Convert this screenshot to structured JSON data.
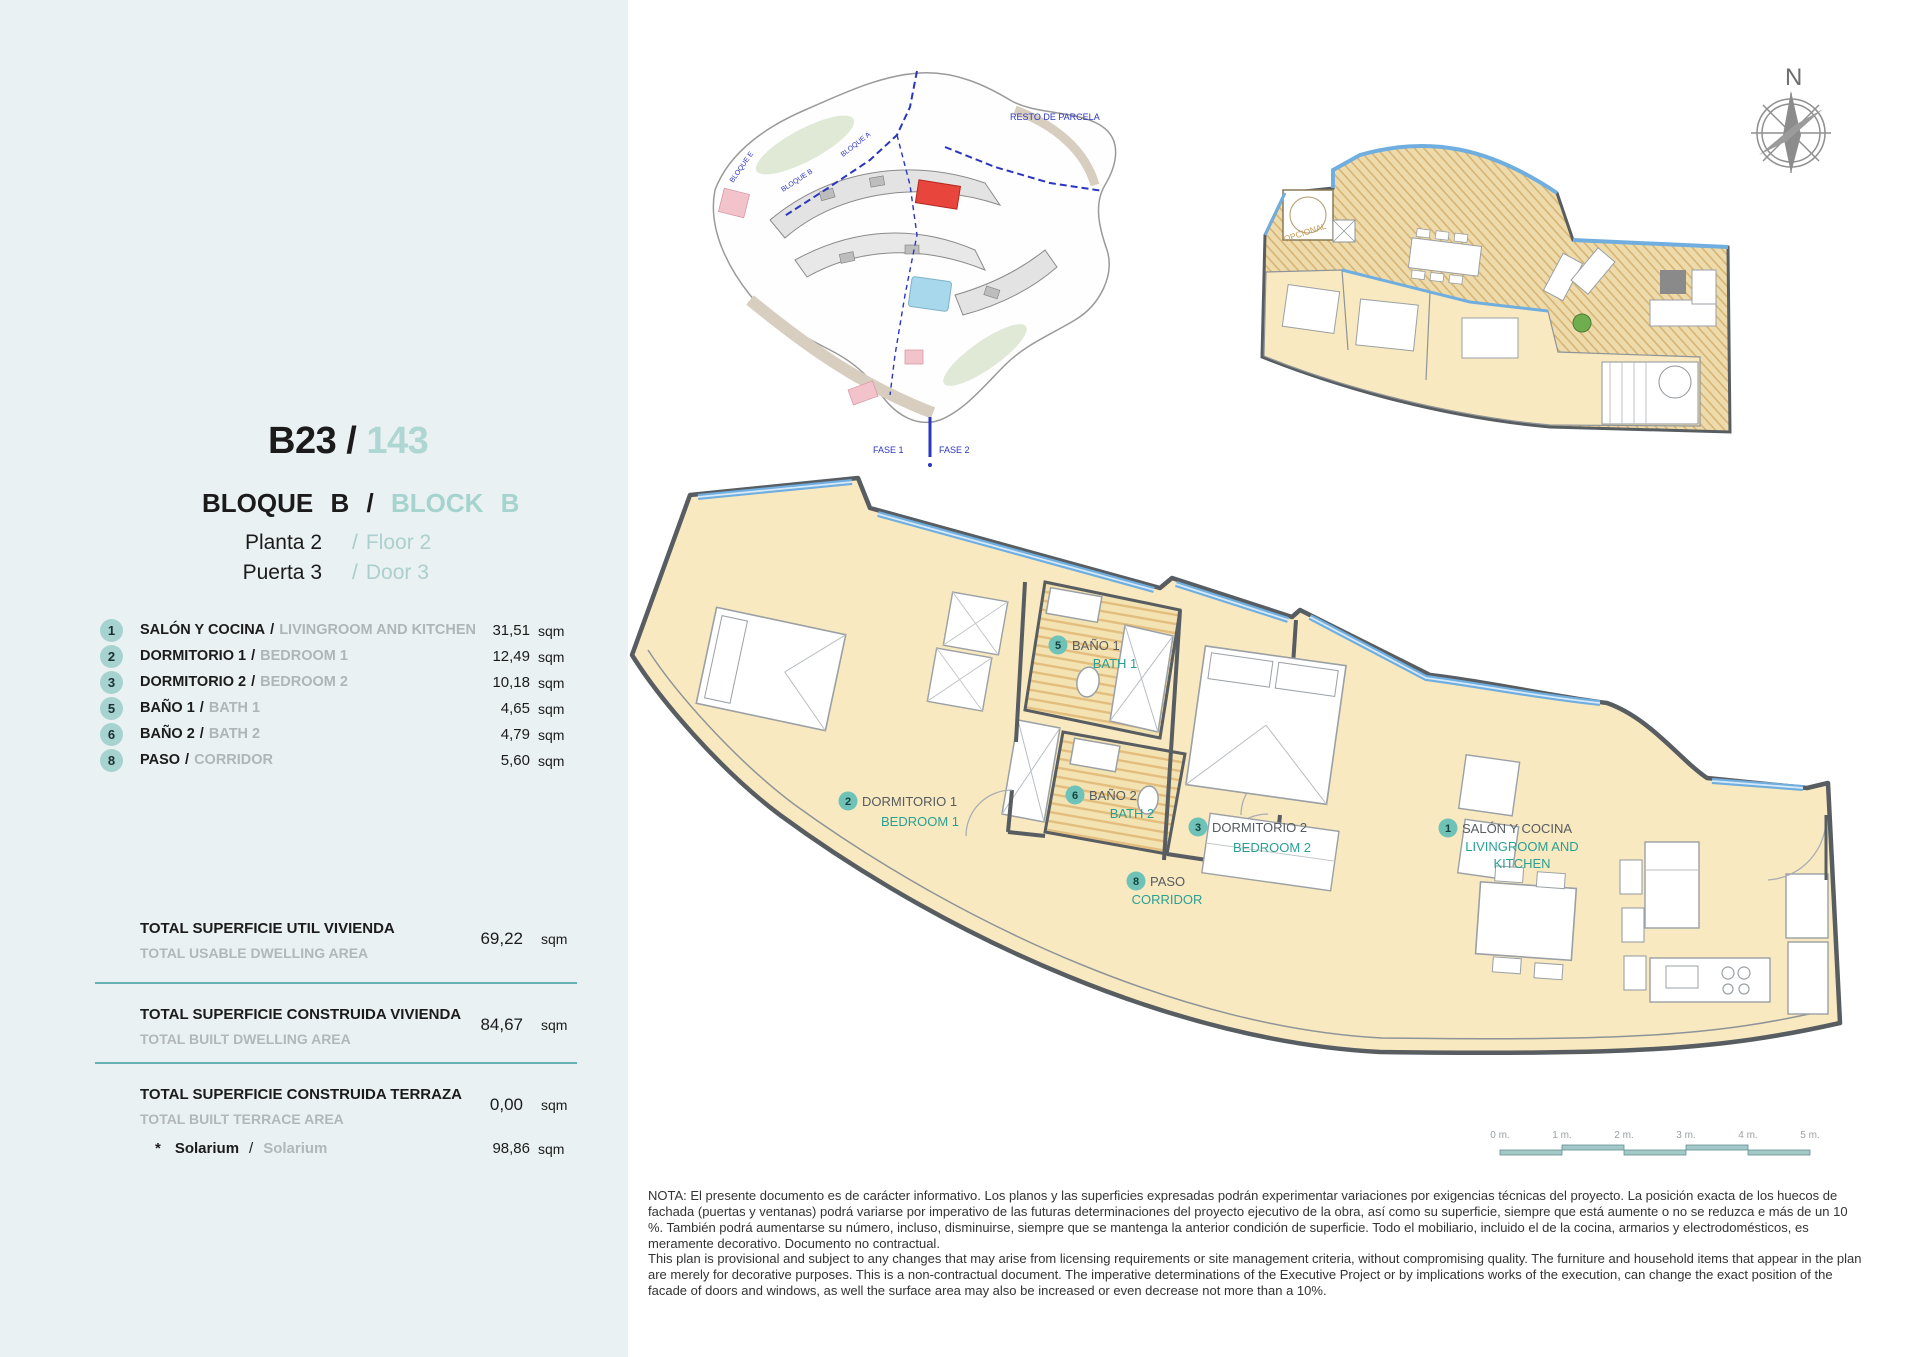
{
  "misc": {
    "slash": "/",
    "sqm": "sqm"
  },
  "unit": {
    "code": "B23",
    "number": "143",
    "block_es": "BLOQUE B",
    "block_en": "BLOCK B",
    "floor_es": "Planta 2",
    "floor_en": "Floor 2",
    "door_es": "Puerta 3",
    "door_en": "Door 3"
  },
  "rooms": [
    {
      "num": "1",
      "es": "SALÓN Y COCINA",
      "en": "LIVINGROOM AND KITCHEN",
      "area": "31,51"
    },
    {
      "num": "2",
      "es": "DORMITORIO 1",
      "en": "BEDROOM 1",
      "area": "12,49"
    },
    {
      "num": "3",
      "es": "DORMITORIO 2",
      "en": "BEDROOM 2",
      "area": "10,18"
    },
    {
      "num": "5",
      "es": "BAÑO 1",
      "en": "BATH 1",
      "area": "4,65"
    },
    {
      "num": "6",
      "es": "BAÑO 2",
      "en": "BATH 2",
      "area": "4,79"
    },
    {
      "num": "8",
      "es": "PASO",
      "en": "CORRIDOR",
      "area": "5,60"
    }
  ],
  "totals": [
    {
      "es": "TOTAL SUPERFICIE UTIL VIVIENDA",
      "en": "TOTAL USABLE DWELLING AREA",
      "value": "69,22"
    },
    {
      "es": "TOTAL SUPERFICIE CONSTRUIDA VIVIENDA",
      "en": "TOTAL BUILT DWELLING AREA",
      "value": "84,67"
    },
    {
      "es": "TOTAL SUPERFICIE CONSTRUIDA TERRAZA",
      "en": "TOTAL BUILT TERRACE AREA",
      "value": "0,00"
    }
  ],
  "solarium": {
    "star": "*",
    "es": "Solarium",
    "en": "Solarium",
    "value": "98,86"
  },
  "plan_labels": {
    "salon": {
      "num": "1",
      "es": "SALÓN Y COCINA",
      "en1": "LIVINGROOM AND",
      "en2": "KITCHEN"
    },
    "bedroom1": {
      "num": "2",
      "es": "DORMITORIO 1",
      "en": "BEDROOM 1"
    },
    "bedroom2": {
      "num": "3",
      "es": "DORMITORIO 2",
      "en": "BEDROOM 2"
    },
    "bath1": {
      "num": "5",
      "es": "BAÑO 1",
      "en": "BATH 1"
    },
    "bath2": {
      "num": "6",
      "es": "BAÑO 2",
      "en": "BATH 2"
    },
    "paso": {
      "num": "8",
      "es": "PASO",
      "en": "CORRIDOR"
    }
  },
  "site_plan": {
    "resto_de_parcela": "RESTO DE PARCELA",
    "fase_1": "FASE 1",
    "fase_2": "FASE 2",
    "bloque_a": "BLOQUE A",
    "bloque_b": "BLOQUE B",
    "bloque_e": "BLOQUE E"
  },
  "upper_plan": {
    "opcional": "OPCIONAL"
  },
  "compass": {
    "north": "N"
  },
  "scale_bar": {
    "labels": [
      "0 m.",
      "1 m.",
      "2 m.",
      "3 m.",
      "4 m.",
      "5 m."
    ]
  },
  "nota": {
    "es": "NOTA: El presente documento es de carácter informativo. Los planos y las superficies expresadas podrán experimentar variaciones por exigencias técnicas del proyecto. La posición exacta de los huecos de fachada (puertas y ventanas) podrá variarse por imperativo de las futuras determinaciones del proyecto ejecutivo de la obra, así como su superficie, siempre que está aumente o no se reduzca e más de un 10 %. También podrá aumentarse su número, incluso, disminuirse, siempre que se mantenga la anterior condición de superficie. Todo el mobiliario, incluido el de la cocina, armarios y electrodomésticos, es meramente decorativo. Documento no contractual.",
    "en": "This plan is provisional and subject to any changes that may arise from licensing requirements or site management criteria, without compromising quality. The furniture and household items that appear in the plan are merely for decorative purposes. This is a non-contractual document. The imperative determinations of the Executive Project or by implications works of the execution, can change the exact position of the facade of doors and windows, as well the surface area may also be increased or even decrease not more than a 10%."
  },
  "colors": {
    "sidebar_bg": "#e9f1f2",
    "accent_teal": "#6ec2b7",
    "divider_teal": "#66b1b4",
    "room_fill": "#f8e9c0",
    "terrace_fill": "#eedbab",
    "highlight_red": "#e8463c",
    "glazing_blue": "#6faede"
  }
}
